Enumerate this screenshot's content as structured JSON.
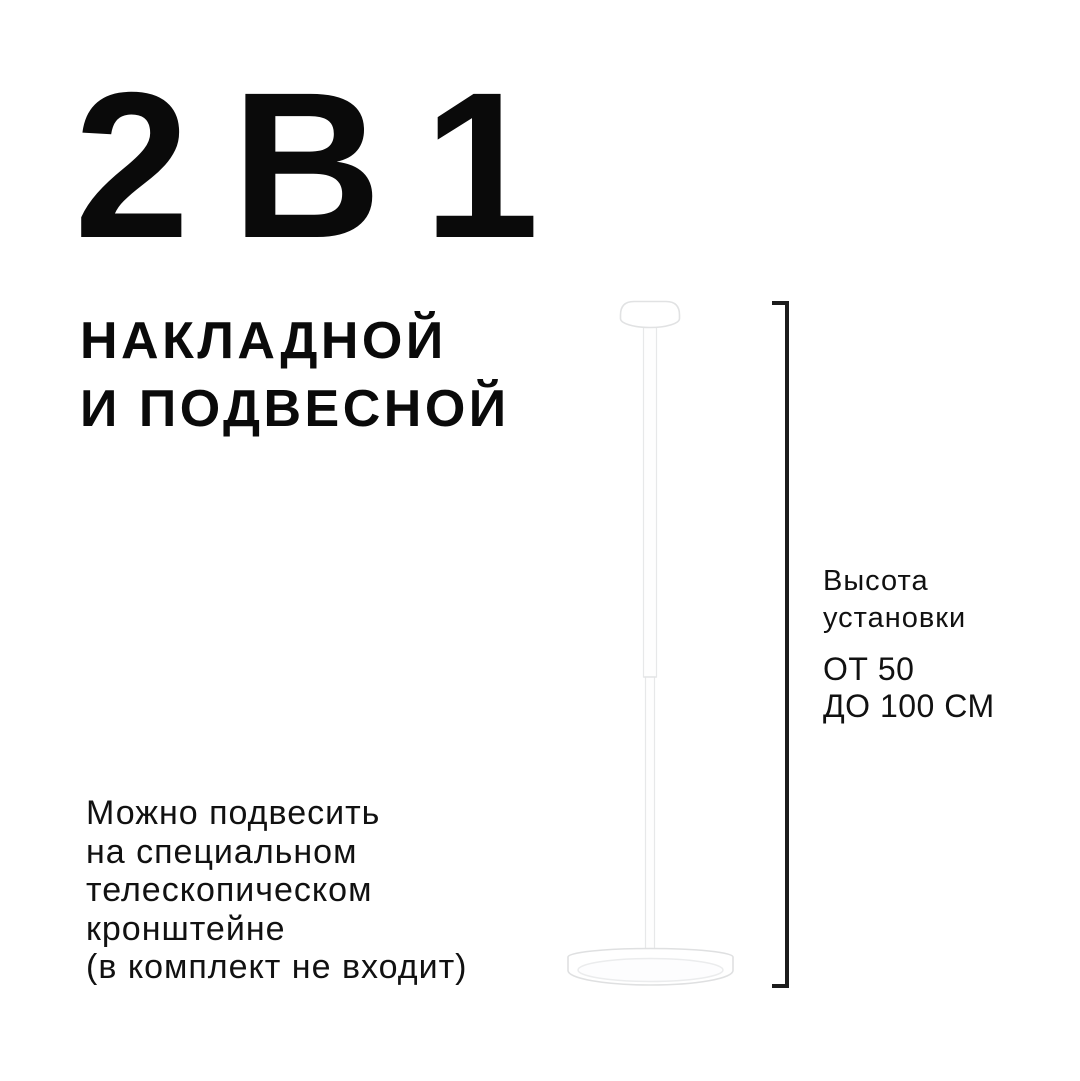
{
  "canvas": {
    "background_color": "#ffffff",
    "text_color": "#0a0a0a"
  },
  "headline": {
    "title": "2 В 1",
    "subtitle_line1": "НАКЛАДНОЙ",
    "subtitle_line2": "И ПОДВЕСНОЙ"
  },
  "dimension": {
    "label_line1": "Высота",
    "label_line2": "установки",
    "value_line1": "ОТ 50",
    "value_line2": "ДО 100 СМ",
    "bracket_color": "#1c1c1c"
  },
  "note": {
    "lines": [
      "Можно подвесить",
      "на специальном",
      "телескопическом",
      "кронштейне",
      "(в комплект не входит)"
    ]
  },
  "illustration": {
    "name": "pendant-lamp-2-in-1",
    "fill_color": "#ffffff",
    "outline_color": "#e1e2e3",
    "diffuser_outline_color": "#ebeced"
  }
}
